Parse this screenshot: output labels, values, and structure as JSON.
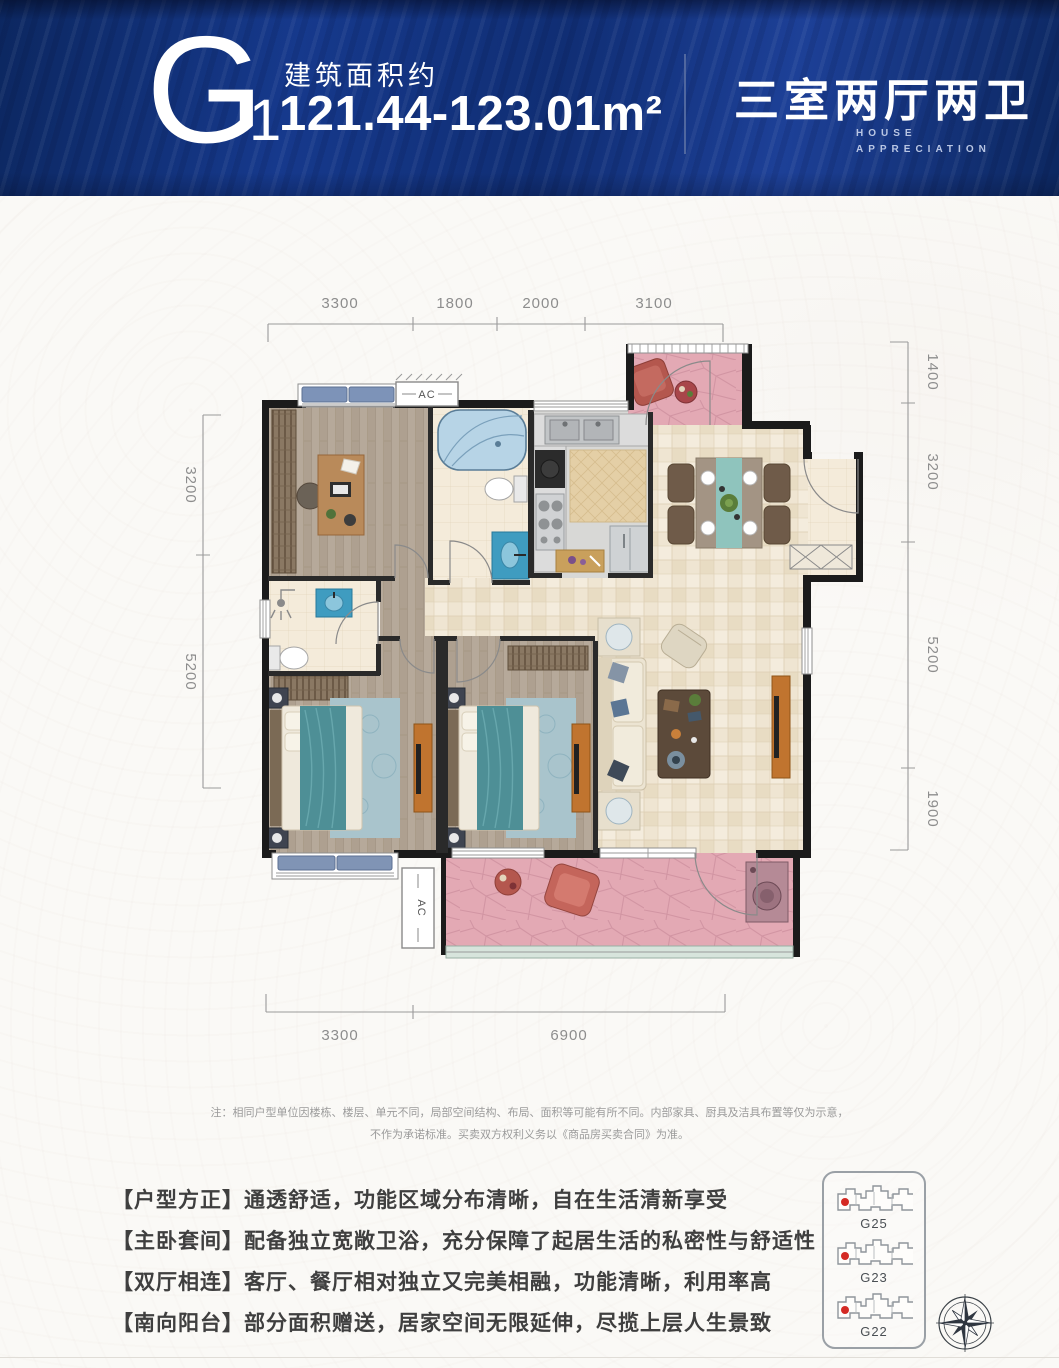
{
  "header": {
    "plan_code": "G",
    "plan_code_sub": "1",
    "area_label": "建筑面积约",
    "area_value": "121.44-123.01m²",
    "layout_title": "三室两厅两卫",
    "subtitle_line1": "HOUSE",
    "subtitle_line2": "APPRECIATION"
  },
  "plan": {
    "dims": {
      "top": [
        "3300",
        "1800",
        "2000",
        "3100"
      ],
      "bottom": [
        "3300",
        "6900"
      ],
      "left": [
        "3200",
        "5200"
      ],
      "right": [
        "1400",
        "3200",
        "5200",
        "1900"
      ]
    },
    "ac_top": "AC",
    "ac_bottom": "AC"
  },
  "note": {
    "line1": "注：相同户型单位因楼栋、楼层、单元不同，局部空间结构、布局、面积等可能有所不同。内部家具、厨具及洁具布置等仅为示意，",
    "line2": "不作为承诺标准。买卖双方权利义务以《商品房买卖合同》为准。"
  },
  "features": [
    "【户型方正】通透舒适，功能区域分布清晰，自在生活清新享受",
    "【主卧套间】配备独立宽敞卫浴，充分保障了起居生活的私密性与舒适性",
    "【双厅相连】客厅、餐厅相对独立又完美相融，功能清晰，利用率高",
    "【南向阳台】部分面积赠送，居家空间无限延伸，尽揽上层人生景致"
  ],
  "locator": {
    "buildings": [
      {
        "label": "G25"
      },
      {
        "label": "G23"
      },
      {
        "label": "G22"
      }
    ]
  },
  "colors": {
    "header_blue": "#16398c",
    "balcony_pink": "#e3a9b4",
    "accent_teal": "#4e8f96",
    "highlight_red": "#d42a24"
  }
}
